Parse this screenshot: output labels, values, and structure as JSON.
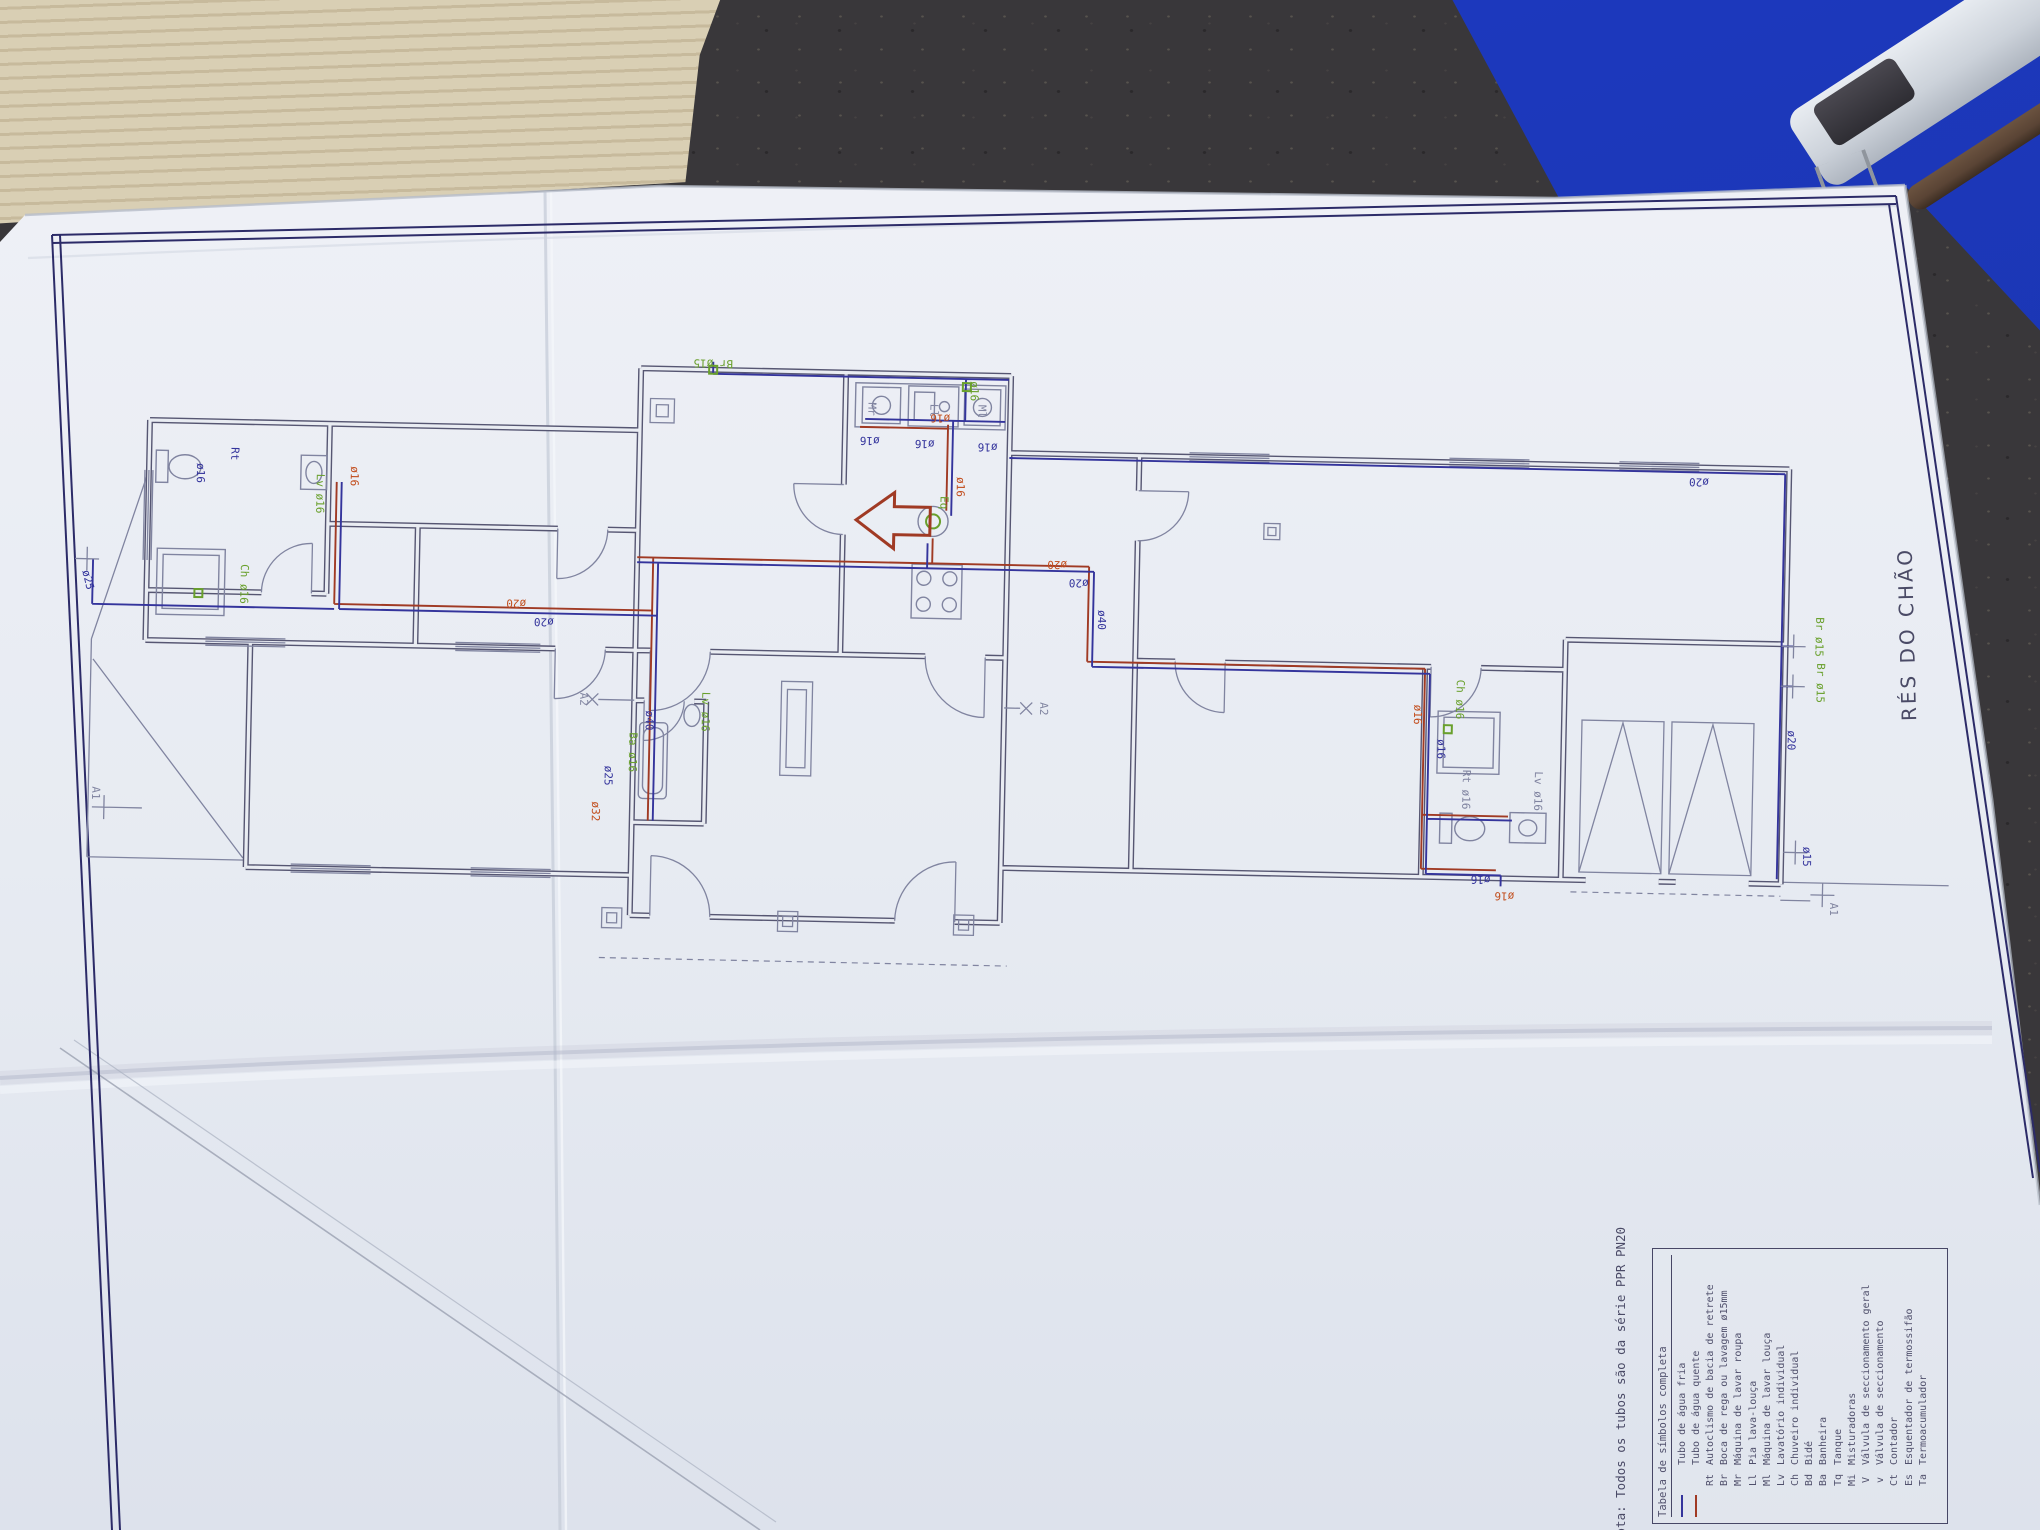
{
  "palette": {
    "surface": "#39373a",
    "cardboard": "#d9cfb4",
    "cardboard_stripe": "#c7ba9c",
    "folder_blue": "#1b36b4",
    "clip_body": "#ccd2da",
    "clip_dark": "#2e2d33",
    "rod_brown": "#5a4435",
    "paper": "#e9ecf2",
    "paper_deep": "#dde2ec",
    "crease": "#c6ccd8",
    "frame": "#2c2b68",
    "wall": "#565672",
    "wall_thin": "#8084a0",
    "cold": "#34349c",
    "hot": "#a03a24",
    "hot_label": "#c24e1e",
    "green": "#69a02c",
    "text_dark": "#4a4a66"
  },
  "drawing": {
    "title": "RÉS DO CHÃO",
    "note": "Nota: Todos os tubos são da série PPR PN20",
    "legend": {
      "title": "Tabela de símbolos completa",
      "entries": [
        {
          "swatch_class": "lsw sw-cold",
          "code": "",
          "label": "Tubo de água fria"
        },
        {
          "swatch_class": "lsw sw-hot",
          "code": "",
          "label": "Tubo de água quente"
        },
        {
          "swatch_class": "lsw",
          "code": "Rt",
          "label": "Autoclismo de bacia de retrete"
        },
        {
          "swatch_class": "lsw",
          "code": "Br",
          "label": "Boca de rega ou lavagem ø15mm"
        },
        {
          "swatch_class": "lsw",
          "code": "Mr",
          "label": "Máquina de lavar roupa"
        },
        {
          "swatch_class": "lsw",
          "code": "Ll",
          "label": "Pia lava-louça"
        },
        {
          "swatch_class": "lsw",
          "code": "Ml",
          "label": "Máquina de lavar louça"
        },
        {
          "swatch_class": "lsw",
          "code": "Lv",
          "label": "Lavatório individual"
        },
        {
          "swatch_class": "lsw",
          "code": "Ch",
          "label": "Chuveiro individual"
        },
        {
          "swatch_class": "lsw",
          "code": "Bd",
          "label": "Bidé"
        },
        {
          "swatch_class": "lsw",
          "code": "Ba",
          "label": "Banheira"
        },
        {
          "swatch_class": "lsw",
          "code": "Tq",
          "label": "Tanque"
        },
        {
          "swatch_class": "lsw",
          "code": "Mi",
          "label": "Misturadoras"
        },
        {
          "swatch_class": "lsw",
          "code": "V",
          "label": "Válvula de seccionamento geral"
        },
        {
          "swatch_class": "lsw",
          "code": "v",
          "label": "Válvula de seccionamento"
        },
        {
          "swatch_class": "lsw",
          "code": "Ct",
          "label": "Contador"
        },
        {
          "swatch_class": "lsw",
          "code": "Es",
          "label": "Esquentador de termossifão"
        },
        {
          "swatch_class": "lsw",
          "code": "Ta",
          "label": "Termoacumulador"
        }
      ]
    },
    "plan": {
      "labels": [
        {
          "t": "ø25",
          "c": "cold",
          "x": 88,
          "y": 582,
          "r": 75
        },
        {
          "t": "ø16",
          "c": "cold",
          "x": 198,
          "y": 472,
          "r": 90
        },
        {
          "t": "Rt",
          "c": "cold",
          "x": 232,
          "y": 452,
          "r": 90
        },
        {
          "t": "Ch ø16",
          "c": "green",
          "x": 244,
          "y": 582,
          "r": 90
        },
        {
          "t": "Lv ø16",
          "c": "green",
          "x": 318,
          "y": 490,
          "r": 90
        },
        {
          "t": "ø16",
          "c": "hot",
          "x": 352,
          "y": 472,
          "r": 90
        },
        {
          "t": "ø20",
          "c": "hot",
          "x": 520,
          "y": 592,
          "r": 180
        },
        {
          "t": "ø20",
          "c": "cold",
          "x": 548,
          "y": 610,
          "r": 180
        },
        {
          "t": "A1",
          "c": "wall",
          "x": 100,
          "y": 794,
          "r": 90
        },
        {
          "t": "Lv ø16",
          "c": "green",
          "x": 708,
          "y": 700,
          "r": 90
        },
        {
          "t": "Ba ø16",
          "c": "green",
          "x": 636,
          "y": 742,
          "r": 90
        },
        {
          "t": "ø25",
          "c": "cold",
          "x": 612,
          "y": 766,
          "r": 90
        },
        {
          "t": "ø32",
          "c": "hot",
          "x": 600,
          "y": 802,
          "r": 90
        },
        {
          "t": "ø40",
          "c": "cold",
          "x": 652,
          "y": 710,
          "r": 90
        },
        {
          "t": "A2",
          "c": "wall",
          "x": 586,
          "y": 690,
          "r": 90
        },
        {
          "t": "A2",
          "c": "wall",
          "x": 1046,
          "y": 690,
          "r": 90
        },
        {
          "t": "Br ø15",
          "c": "green",
          "x": 712,
          "y": 348,
          "r": 180
        },
        {
          "t": "ø16",
          "c": "cold",
          "x": 870,
          "y": 422,
          "r": 180
        },
        {
          "t": "ø16",
          "c": "cold",
          "x": 925,
          "y": 424,
          "r": 180
        },
        {
          "t": "ø16",
          "c": "cold",
          "x": 988,
          "y": 426,
          "r": 180
        },
        {
          "t": "ø16",
          "c": "hot",
          "x": 940,
          "y": 398,
          "r": 180
        },
        {
          "t": "ø16",
          "c": "green",
          "x": 970,
          "y": 374,
          "r": 90
        },
        {
          "t": "Mr",
          "c": "wall",
          "x": 868,
          "y": 394,
          "r": 90
        },
        {
          "t": "Ll",
          "c": "wall",
          "x": 930,
          "y": 394,
          "r": 90
        },
        {
          "t": "Ml",
          "c": "wall",
          "x": 978,
          "y": 394,
          "r": 90
        },
        {
          "t": "Eq",
          "c": "green",
          "x": 942,
          "y": 486,
          "r": 90
        },
        {
          "t": "ø16",
          "c": "hot",
          "x": 958,
          "y": 470,
          "r": 90
        },
        {
          "t": "ø20",
          "c": "hot",
          "x": 1060,
          "y": 542,
          "r": 180
        },
        {
          "t": "ø20",
          "c": "cold",
          "x": 1082,
          "y": 560,
          "r": 180
        },
        {
          "t": "ø40",
          "c": "cold",
          "x": 1102,
          "y": 600,
          "r": 90
        },
        {
          "t": "ø20",
          "c": "cold",
          "x": 1700,
          "y": 446,
          "r": 180
        },
        {
          "t": "ø20",
          "c": "cold",
          "x": 1794,
          "y": 706,
          "r": 90
        },
        {
          "t": "Br ø15",
          "c": "green",
          "x": 1820,
          "y": 602,
          "r": 90
        },
        {
          "t": "Br ø15",
          "c": "green",
          "x": 1822,
          "y": 648,
          "r": 90
        },
        {
          "t": "ø15",
          "c": "cold",
          "x": 1812,
          "y": 822,
          "r": 90
        },
        {
          "t": "A1",
          "c": "wall",
          "x": 1840,
          "y": 874,
          "r": 90
        },
        {
          "t": "ø16",
          "c": "hot",
          "x": 1420,
          "y": 688,
          "r": 90
        },
        {
          "t": "ø16",
          "c": "cold",
          "x": 1444,
          "y": 722,
          "r": 90
        },
        {
          "t": "Ch ø16",
          "c": "green",
          "x": 1462,
          "y": 672,
          "r": 90
        },
        {
          "t": "Rt ø16",
          "c": "wall",
          "x": 1470,
          "y": 762,
          "r": 90
        },
        {
          "t": "Lv ø16",
          "c": "wall",
          "x": 1542,
          "y": 762,
          "r": 90
        },
        {
          "t": "ø16",
          "c": "cold",
          "x": 1490,
          "y": 848,
          "r": 180
        },
        {
          "t": "ø16",
          "c": "hot",
          "x": 1514,
          "y": 864,
          "r": 180
        }
      ]
    }
  }
}
